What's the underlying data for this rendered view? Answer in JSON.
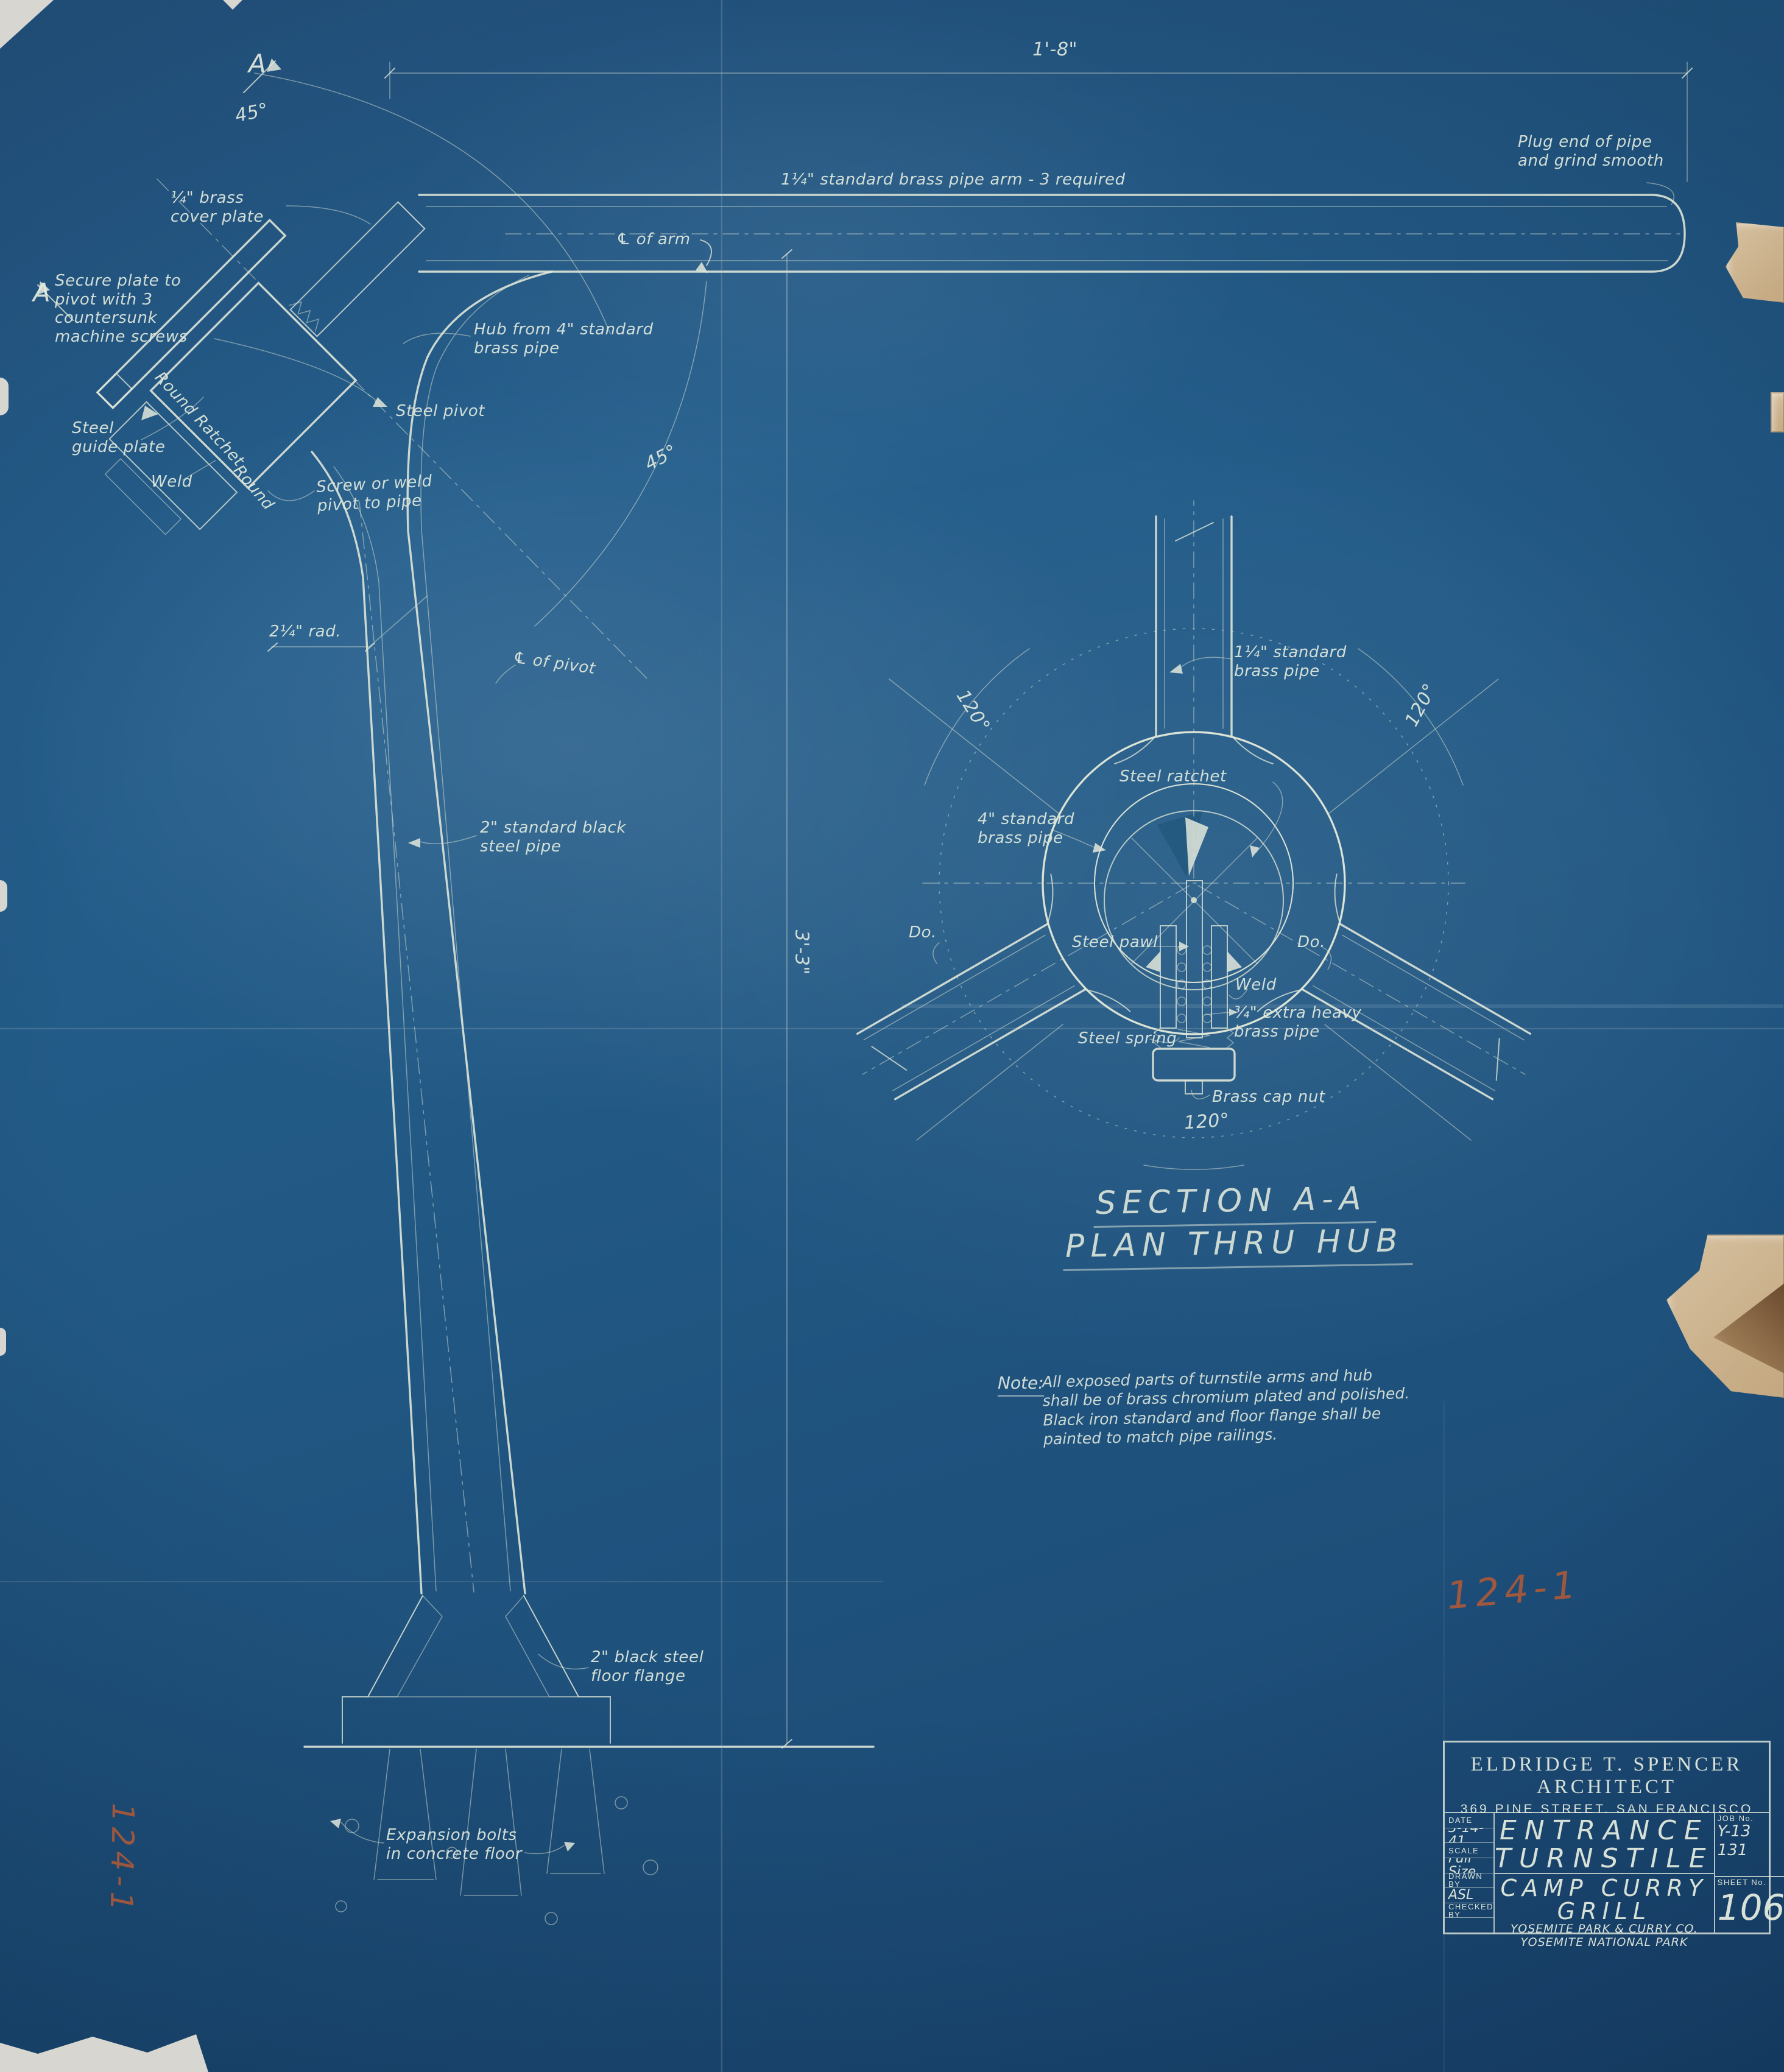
{
  "labels": {
    "dim_arm_length": "1'-8\"",
    "plug_end": "Plug end of pipe\nand grind smooth",
    "arm_pipe": "1¼\" standard brass pipe arm  -  3 required",
    "cl_arm": "℄ of arm",
    "angle_45_top": "45°",
    "angle_45_mid": "45°",
    "cover_plate": "¼\" brass\ncover plate",
    "secure_plate": "Secure plate to\npivot with 3\ncountersunk\nmachine screws",
    "guide_plate": "Steel\nguide plate",
    "weld_elev": "Weld",
    "round_ratchet": "Round Ratchet",
    "round2": "Round",
    "steel_pivot": "Steel pivot",
    "screw_weld": "Screw or weld\npivot to pipe",
    "hub_from": "Hub from 4\" standard\nbrass pipe",
    "marker_a_top": "A",
    "marker_a_bottom": "A",
    "rad": "2¼\" rad.",
    "cl_pivot": "℄ of pivot",
    "post_pipe": "2\" standard black\nsteel pipe",
    "dim_height": "3'-3\"",
    "plan_arm_pipe": "1¼\" standard\nbrass pipe",
    "angle_120_right": "120°",
    "angle_120_left": "120°",
    "angle_120_bottom": "120°",
    "plan_hub_pipe": "4\" standard\nbrass pipe",
    "steel_ratchet": "Steel ratchet",
    "steel_pawl": "Steel pawl",
    "do_left": "Do.",
    "do_right": "Do.",
    "weld_plan": "Weld",
    "spring_pipe": "¾\" extra heavy\nbrass pipe",
    "steel_spring": "Steel spring",
    "brass_cap": "Brass cap nut",
    "floor_flange": "2\" black steel\nfloor flange",
    "expansion": "Expansion bolts\nin concrete floor"
  },
  "headings": {
    "section": "SECTION A-A",
    "plan": "PLAN THRU HUB"
  },
  "note": {
    "label": "Note:",
    "text": "All exposed parts of turnstile arms and hub\nshall be of brass chromium plated and polished.\nBlack iron standard and floor flange shall be\npainted to match pipe railings."
  },
  "stamps": {
    "red_number": "124-1",
    "red_number_vertical": "124-1"
  },
  "title_block": {
    "firm": "ELDRIDGE T. SPENCER ARCHITECT",
    "address": "369 PINE STREET. SAN FRANCISCO",
    "date_label": "DATE",
    "date": "3-14-41",
    "scale_label": "SCALE",
    "scale": "Full Size",
    "drawn_label": "DRAWN BY",
    "drawn": "ASL",
    "checked_label": "CHECKED BY",
    "checked": "",
    "job_label": "JOB No.",
    "job_line1": "Y-13",
    "job_line2": "131",
    "sheet_label": "SHEET No.",
    "sheet": "106",
    "title_line1": "ENTRANCE",
    "title_line2": "TURNSTILE",
    "project_line1": "CAMP CURRY",
    "project_line2": "GRILL",
    "owner_line1": "YOSEMITE PARK & CURRY CO.",
    "owner_line2": "YOSEMITE NATIONAL PARK"
  },
  "colors": {
    "blueprint_blue": "#225a86",
    "line_cream": "#dee5d7",
    "stamp_red": "#b65a35",
    "tear_tan": "#c9ad85"
  }
}
